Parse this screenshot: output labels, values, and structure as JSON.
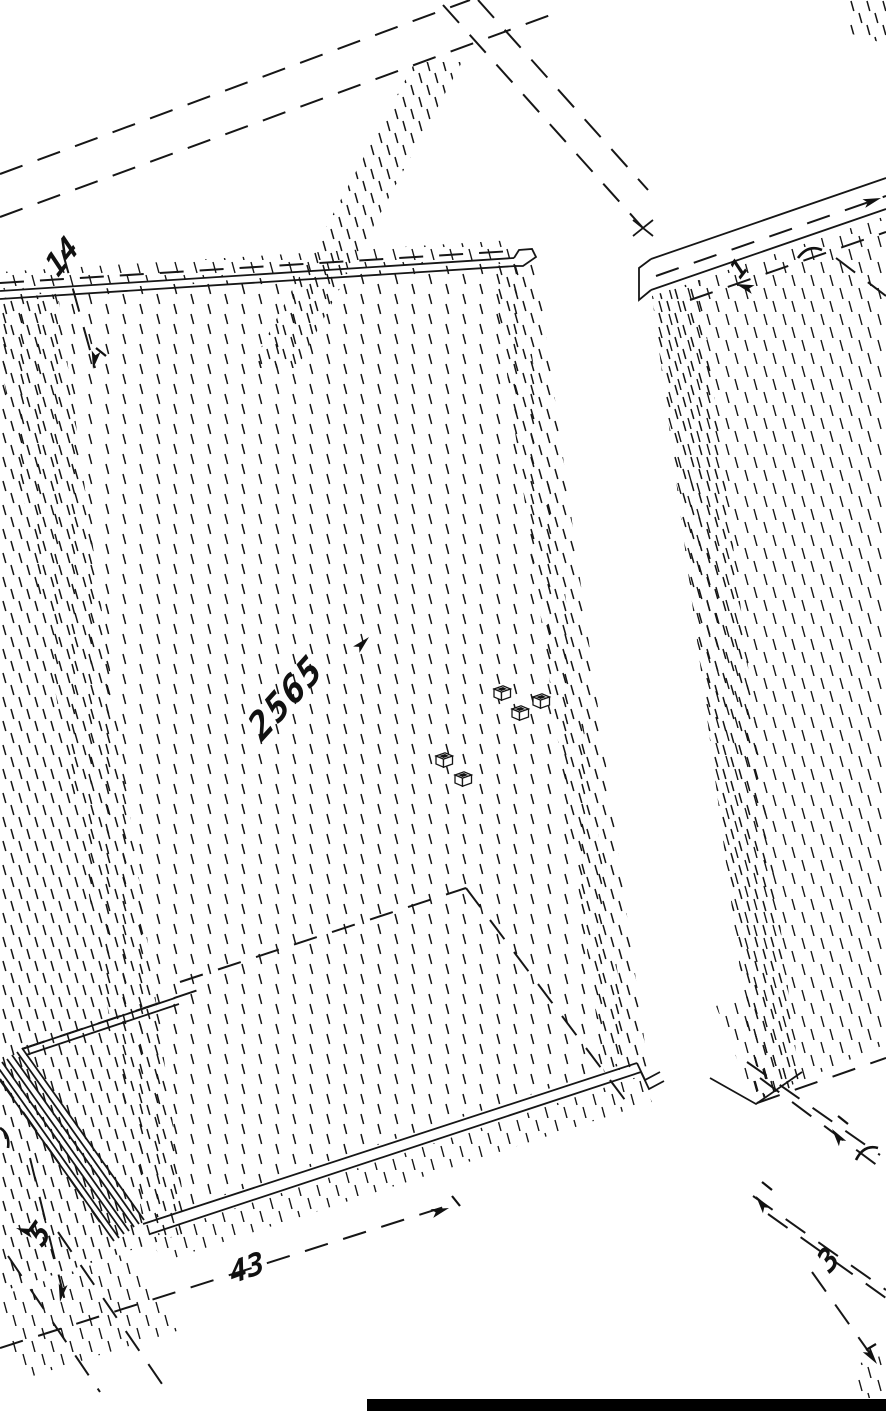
{
  "drawing": {
    "title": "isometric-cad-panel-drawing",
    "colors": {
      "ink": "#161616",
      "background": "#ffffff",
      "scale_bar": "#000000"
    },
    "labels": [
      {
        "id": "dim-14",
        "text": "14"
      },
      {
        "id": "part-2565",
        "text": "2565"
      },
      {
        "id": "dim-1",
        "text": "1"
      },
      {
        "id": "dim-5",
        "text": "5"
      },
      {
        "id": "dim-43",
        "text": "43"
      },
      {
        "id": "dim-3",
        "text": "3"
      }
    ],
    "scale_bar": {
      "present": true
    }
  }
}
